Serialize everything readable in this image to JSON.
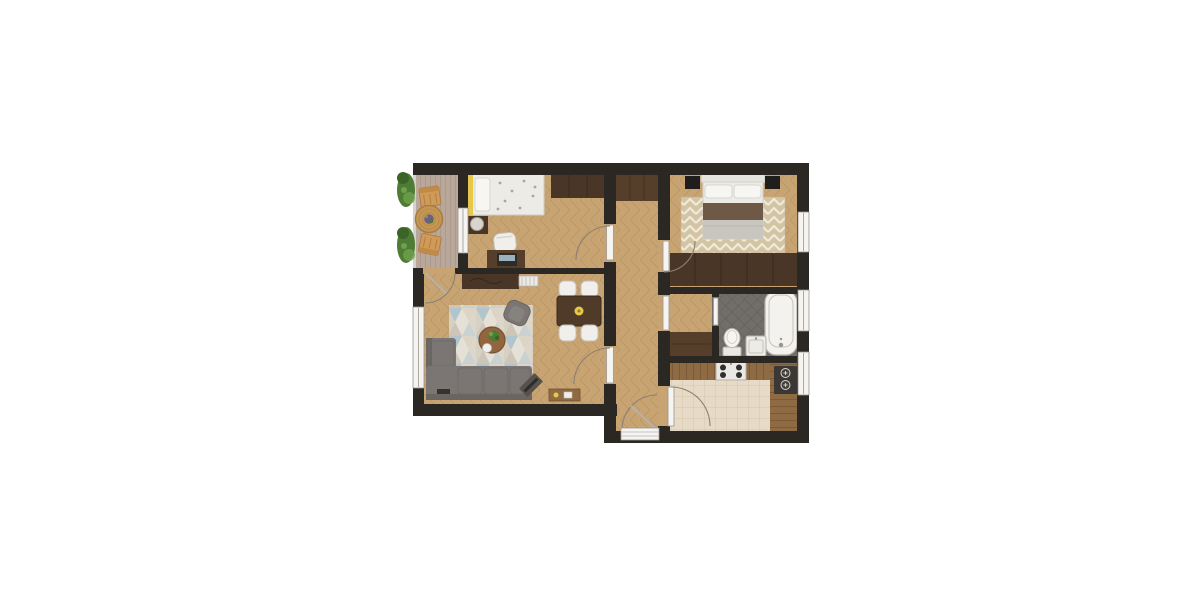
{
  "scene": {
    "type": "floor-plan",
    "view": "top-down-render",
    "background": "#ffffff",
    "description": "Two-bedroom apartment floor plan with balcony, rendered top-down"
  },
  "colors": {
    "wall": "#2b2823",
    "floor_wood": "#c9a473",
    "floor_seam": "#ab885a",
    "deck": "#b9a79a",
    "deck_seam": "#a6938a",
    "tile_kitchen": "#e7dbc7",
    "tile_kitchen_seam": "#d6c7ae",
    "tile_bath": "#716d69",
    "tile_bath_seam": "#605c58",
    "rug_cream": "#e6e1d6",
    "rug_blue": "#b0c6cc",
    "rug_gray": "#cdc6b8",
    "rug_sand": "#dcd4c5",
    "chevron_base": "#d3c4a5",
    "chevron_zig": "#f0ead9",
    "furn_dark": "#4a3627",
    "furn_dark2": "#553f2b",
    "counter_wood": "#8f6b44",
    "counter_seam": "#7a5a39",
    "sofa": "#7b7673",
    "sofa_dark": "#696561",
    "white_furn": "#f1efeb",
    "bed_white": "#edebe6",
    "pillow_white": "#f7f6f3",
    "blanket_gray": "#c9c5bf",
    "throw_brown": "#6e5846",
    "black_furn": "#201e1c",
    "yellow": "#e8c84b",
    "green": "#4e7c35",
    "green_dark": "#3c6428",
    "green_light": "#6fa04b",
    "orange": "#d09a58",
    "wicker": "#c69754",
    "purple": "#6f5d85",
    "fixture_white": "#f5f4f1",
    "fixture_stroke": "#b5b1ac",
    "arc": "#8b8070",
    "window_frame": "#9a958e",
    "lamp": "#d8d5cf",
    "appliance_dark": "#3a3734",
    "laptop": "#2d2b28"
  },
  "rooms": [
    {
      "id": "balcony",
      "label": "Balcony",
      "furniture": [
        "planter-box",
        "planter-box",
        "garden-chair",
        "garden-chair",
        "round-wicker-table",
        "potted-plant"
      ]
    },
    {
      "id": "bedroom-study",
      "label": "Bedroom / Study",
      "furniture": [
        "single-bed",
        "pillow",
        "nightstand",
        "table-lamp",
        "desk",
        "laptop",
        "desk-chair",
        "wardrobe"
      ]
    },
    {
      "id": "living-room",
      "label": "Living Room",
      "furniture": [
        "corner-sofa",
        "triangle-rug",
        "coffee-table",
        "houseplant",
        "tray",
        "armchair",
        "tv",
        "dining-table",
        "dining-chair",
        "dining-chair",
        "dining-chair",
        "dining-chair",
        "sideboard",
        "radiator",
        "console-table"
      ]
    },
    {
      "id": "hallway",
      "label": "Hallway",
      "furniture": [
        "built-in-closet"
      ]
    },
    {
      "id": "master-bedroom",
      "label": "Master Bedroom",
      "furniture": [
        "double-bed",
        "pillow",
        "pillow",
        "nightstand",
        "nightstand",
        "chevron-rug",
        "wardrobe"
      ]
    },
    {
      "id": "vestibule",
      "label": "Bathroom Vestibule",
      "furniture": [
        "cabinet"
      ]
    },
    {
      "id": "bathroom",
      "label": "Bathroom",
      "furniture": [
        "bathtub",
        "toilet",
        "washbasin"
      ]
    },
    {
      "id": "kitchen",
      "label": "Kitchen",
      "furniture": [
        "kitchen-counter",
        "stove-four-burner",
        "side-counter",
        "dark-sink-unit"
      ]
    }
  ],
  "openings": {
    "windows": 5,
    "interior_doors": 6,
    "balcony_door": 1,
    "entrance_door": 1
  }
}
